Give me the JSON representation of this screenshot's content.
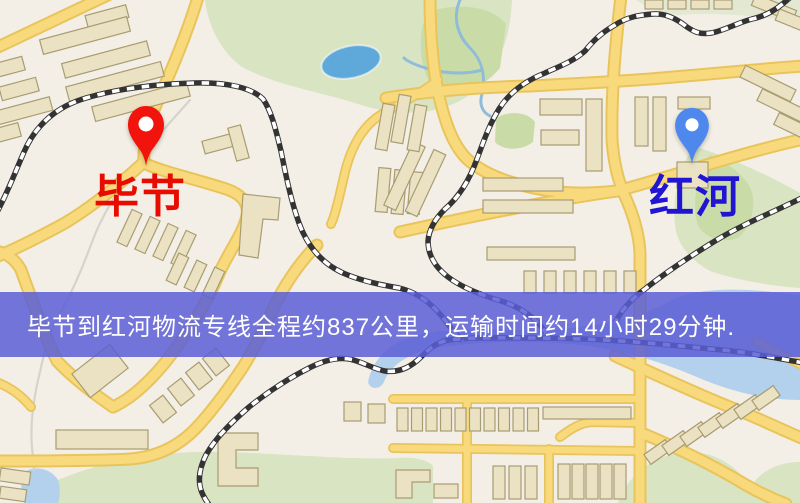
{
  "window": {
    "width_px": 800,
    "height_px": 503,
    "kind": "map-route-screenshot"
  },
  "map": {
    "origin": {
      "label": "毕节",
      "icon": "red-map-pin-icon",
      "label_color": "#e80b00",
      "pin_color": "#f2140c"
    },
    "destination": {
      "label": "红河",
      "icon": "blue-map-pin-icon",
      "label_color": "#2114d2",
      "pin_color": "#4f88ec"
    }
  },
  "banner": {
    "text": "毕节到红河物流专线全程约837公里，运输时间约14小时29分钟.",
    "background_color": "#5a5ed6d9",
    "text_color": "#ffffff"
  },
  "colors": {
    "map_background": "#f3efe6",
    "road_fill": "#f8da7d",
    "road_casing": "#e9c45c",
    "building_fill": "#ebe2c3",
    "building_stroke": "#a89c72",
    "park_green": "#d9e4c2",
    "park_green_dark": "#c9dca8",
    "park_pale": "#e2e8d2",
    "water_blue": "#b3d1ec",
    "lake_blue": "#5fa9da",
    "river_blue": "#8fbcd9",
    "river_grey": "#d6d3ca",
    "railway_dark": "#333333",
    "railway_light": "#ffffff",
    "banner_bg": "#5a5ed6d9",
    "banner_text": "#ffffff"
  }
}
